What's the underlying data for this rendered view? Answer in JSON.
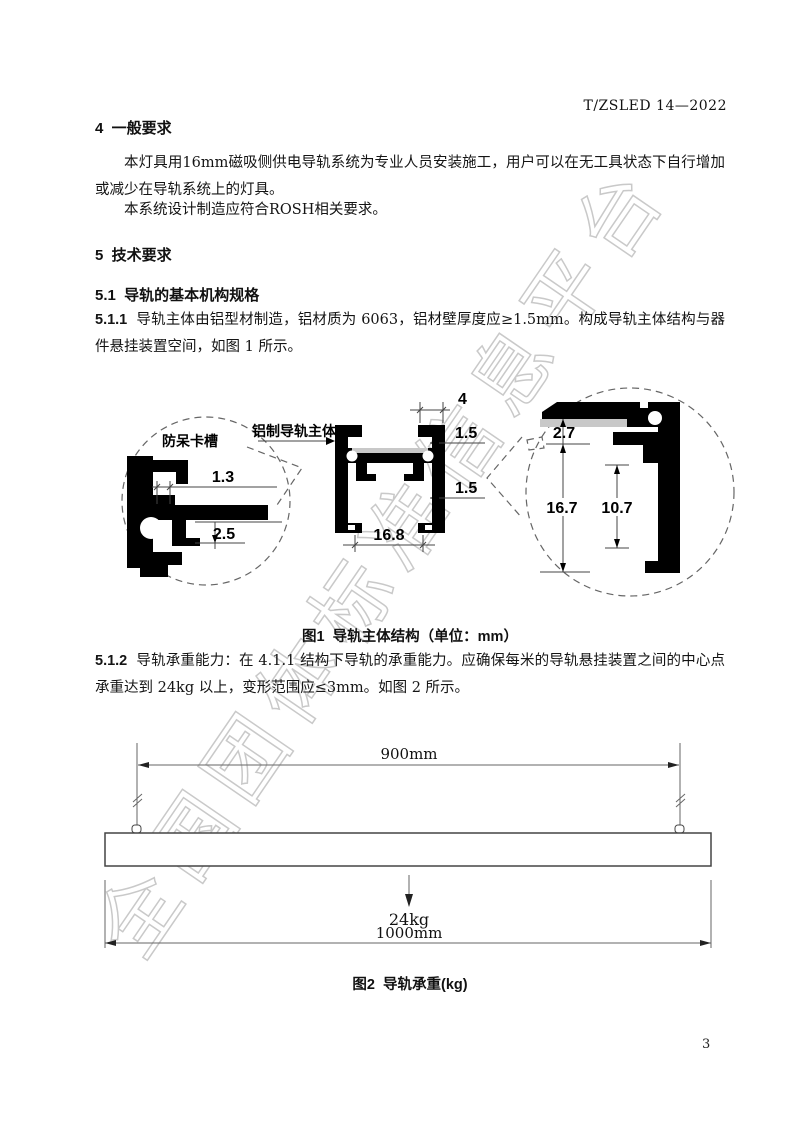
{
  "page": {
    "header_code": "T/ZSLED 14—2022",
    "page_number": "3",
    "watermark": "全国团体标准信息平台"
  },
  "content": {
    "h4": "4  一般要求",
    "p4_1": "本灯具用16mm磁吸侧供电导轨系统为专业人员安装施工，用户可以在无工具状态下自行增加或减少在导轨系统上的灯具。",
    "p4_2": "本系统设计制造应符合ROSH相关要求。",
    "h5": "5  技术要求",
    "h5_1": "5.1  导轨的基本机构规格",
    "p5_1_1_num": "5.1.1",
    "p5_1_1_text": "导轨主体由铝型材制造，铝材质为 6063，铝材壁厚度应≥1.5mm。构成导轨主体结构与器件悬挂装置空间，如图 1 所示。",
    "p5_1_2_num": "5.1.2",
    "p5_1_2_text": "导轨承重能力：在 4.1.1 结构下导轨的承重能力。应确保每米的导轨悬挂装置之间的中心点承重达到 24kg 以上，变形范围应≤3mm。如图 2 所示。"
  },
  "figure1": {
    "caption": "图1  导轨主体结构（单位：mm）",
    "labels": {
      "detail": "防呆卡槽",
      "body": "铝制导轨主体"
    },
    "dimensions": {
      "slot_width": "1.3",
      "slot_depth": "2.5",
      "top_tab": "4",
      "wall_top": "1.5",
      "wall_side": "1.5",
      "inner_width": "16.8",
      "strip_thickness": "2.7",
      "cavity_height": "16.7",
      "hook_height": "10.7"
    }
  },
  "figure2": {
    "caption": "图2  导轨承重(kg)",
    "dimensions": {
      "suspension_span": "900mm",
      "load": "24kg",
      "total_length": "1000mm"
    }
  }
}
